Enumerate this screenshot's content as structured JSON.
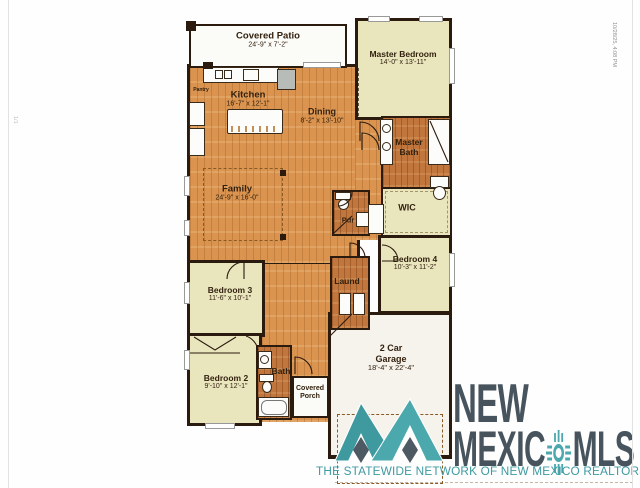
{
  "page": {
    "timestamp": "10/28/25, 4:08 PM",
    "page_indicator": "1/1"
  },
  "plan": {
    "rooms": {
      "covered_patio": {
        "name": "Covered Patio",
        "dims": "24'-9\" x 7'-2\""
      },
      "kitchen": {
        "name": "Kitchen",
        "dims": "16'-7\" x 12'-1\""
      },
      "pantry": {
        "name": "Pantry"
      },
      "dining": {
        "name": "Dining",
        "dims": "8'-2\" x 13'-10\""
      },
      "family": {
        "name": "Family",
        "dims": "24'-9\" x 16'-0\""
      },
      "master_bedroom": {
        "name": "Master Bedroom",
        "dims": "14'-0\" x 13'-11\""
      },
      "master_bath": {
        "name": "Master Bath"
      },
      "wic": {
        "name": "WIC"
      },
      "powder": {
        "name": "Pdr"
      },
      "laundry": {
        "name": "Laund"
      },
      "bedroom4": {
        "name": "Bedroom 4",
        "dims": "10'-3\" x 11'-2\""
      },
      "bedroom3": {
        "name": "Bedroom 3",
        "dims": "11'-6\" x 10'-1\""
      },
      "bedroom2": {
        "name": "Bedroom 2",
        "dims": "9'-10\" x 12'-1\""
      },
      "bath": {
        "name": "Bath"
      },
      "covered_porch": {
        "name": "Covered Porch"
      },
      "garage": {
        "name": "2 Car Garage",
        "dims": "18'-4\" x 22'-4\""
      }
    }
  },
  "logo": {
    "line1": "NEW",
    "line2_left": "MEXIC",
    "line2_right": "MLS",
    "tagline": "THE STATEWIDE NETWORK OF NEW MEXICO REALTORS®",
    "colors": {
      "teal": "#3E9AA1",
      "teal_light": "#4BA8AC",
      "slate": "#47545E"
    }
  }
}
